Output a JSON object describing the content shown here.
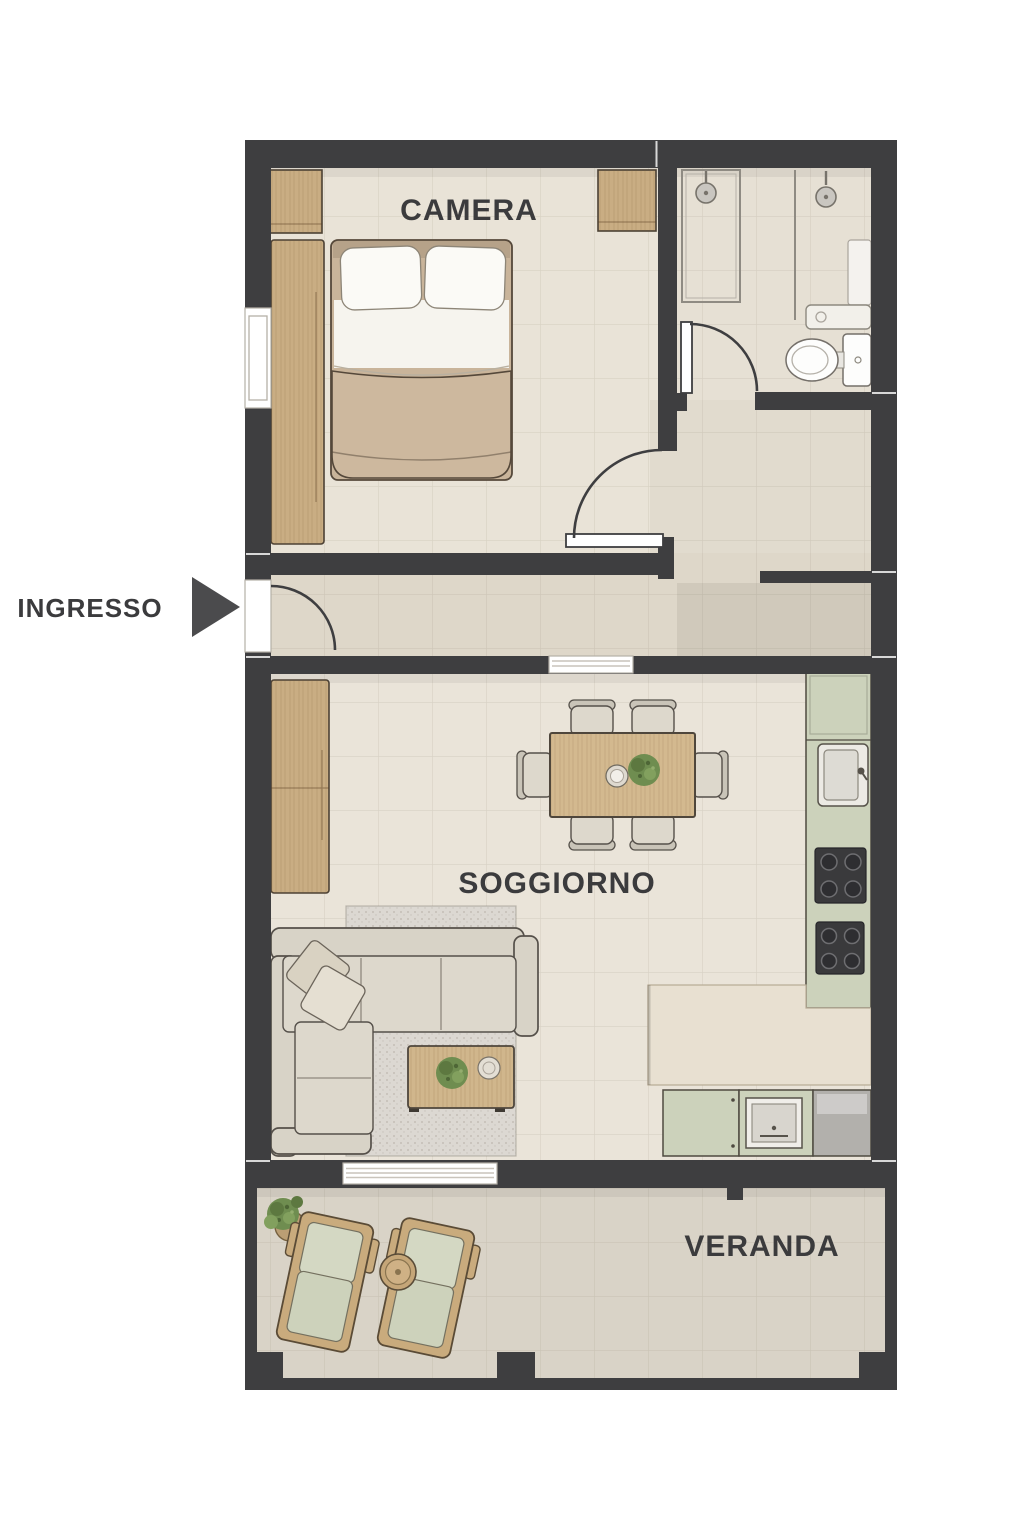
{
  "labels": {
    "bedroom": "CAMERA",
    "entrance": "INGRESSO",
    "living_room": "SOGGIORNO",
    "veranda": "VERANDA"
  },
  "icons": {
    "entrance_arrow": "triangle-right",
    "shower": "shower-head",
    "toilet": "toilet-top-view",
    "plant": "potted-plant-top-view"
  },
  "colors": {
    "wall": "#3e3e40",
    "floor_room": "#e9e3d7",
    "floor_bath": "#e6e0d4",
    "floor_hall": "#e1dbce",
    "floor_corridor": "#ded7c9",
    "floor_living": "#eae4d9",
    "floor_veranda": "#d9d3c7",
    "wood": "#c9ad83",
    "sage": "#ccd2bb",
    "counter": "#e8e0d1",
    "fabric": "#d8d3c7",
    "rug": "#dcd8d2",
    "appliance": "#3a3a3c",
    "plant": "#6f8d50",
    "text": "#3b3b3d",
    "arrow": "#4b4b4d"
  }
}
